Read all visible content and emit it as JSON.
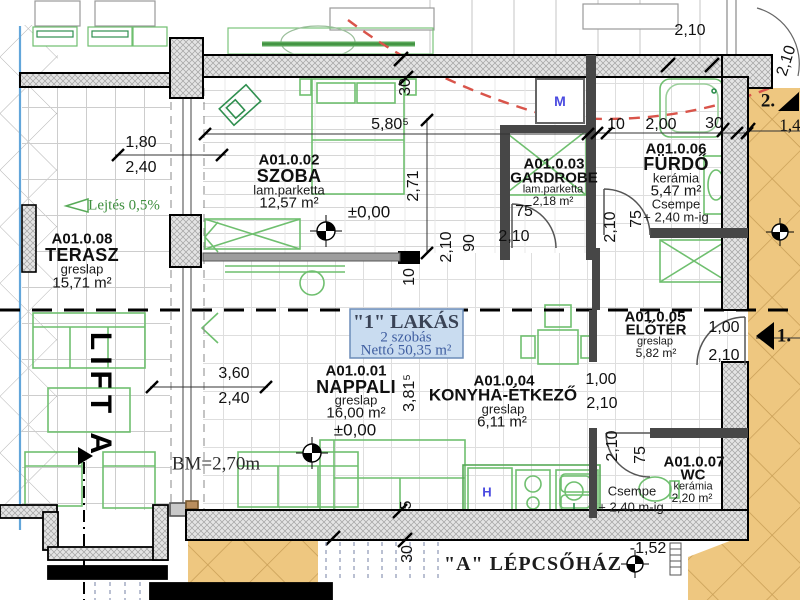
{
  "drawing": {
    "unit_box": {
      "title": "\"1\" LAKÁS",
      "line2": "2 szobás",
      "line3": "Nettó 50,35 m²"
    },
    "rooms": {
      "terasz": {
        "id": "A01.0.08",
        "name": "TERASZ",
        "finish": "greslap",
        "area": "15,71 m²"
      },
      "szoba": {
        "id": "A01.0.02",
        "name": "SZOBA",
        "finish": "lam.parketta",
        "area": "12,57 m²",
        "level": "±0,00"
      },
      "gardrobe": {
        "id": "A01.0.03",
        "name": "GARDROBE",
        "finish": "lam.parketta",
        "area": "2,18 m²"
      },
      "furdo": {
        "id": "A01.0.06",
        "name": "FÜRDŐ",
        "finish": "kerámia",
        "area": "5,47 m²",
        "note1": "Csempe",
        "note2": "+ 2,40 m-ig"
      },
      "nappali": {
        "id": "A01.0.01",
        "name": "NAPPALI",
        "finish": "greslap",
        "area": "16,00 m²",
        "level": "±0,00"
      },
      "konyha": {
        "id": "A01.0.04",
        "name": "KONYHA-ÉTKEZŐ",
        "finish": "greslap",
        "area": "6,11 m²"
      },
      "eloter": {
        "id": "A01.0.05",
        "name": "ELŐTÉR",
        "finish": "greslap",
        "area": "5,82 m²"
      },
      "wc": {
        "id": "A01.0.07",
        "name": "WC",
        "finish": "kerámia",
        "area": "2,20 m²",
        "note1": "Csempe",
        "note2": "+ 2,40 m-ig"
      }
    },
    "labels": {
      "lift": "LIFT A",
      "stairwell": "\"A\" LÉPCSŐHÁZ",
      "clear_height": "BM=2,70m",
      "slope": "Lejtés 0,5%",
      "stair_level": "-1,52",
      "shaft_m": "M",
      "fridge_h": "H",
      "dir2": "2.",
      "dir1": "1.",
      "dim14": "1,4"
    },
    "dims": {
      "v180": "1,80",
      "v240": "2,40",
      "v580": "5,80⁵",
      "v271": "2,71",
      "v30": "30",
      "v210": "2,10",
      "v10": "10",
      "v200": "2,00",
      "v90": "90",
      "v75": "75",
      "v360": "3,60",
      "v381": "3,81⁵",
      "v100": "1,00",
      "v5": "5",
      "v152": "-1,52"
    },
    "colors": {
      "corridor_tan": "#eec780",
      "wall_fill": "#e4e4e4",
      "furniture_green": "#58aa58",
      "red_dashed": "#d9544a",
      "terrace_edge_blue": "#62a6da",
      "unit_box_bg": "#c9dcf0",
      "unit_box_text": "#3f5ea0"
    }
  }
}
